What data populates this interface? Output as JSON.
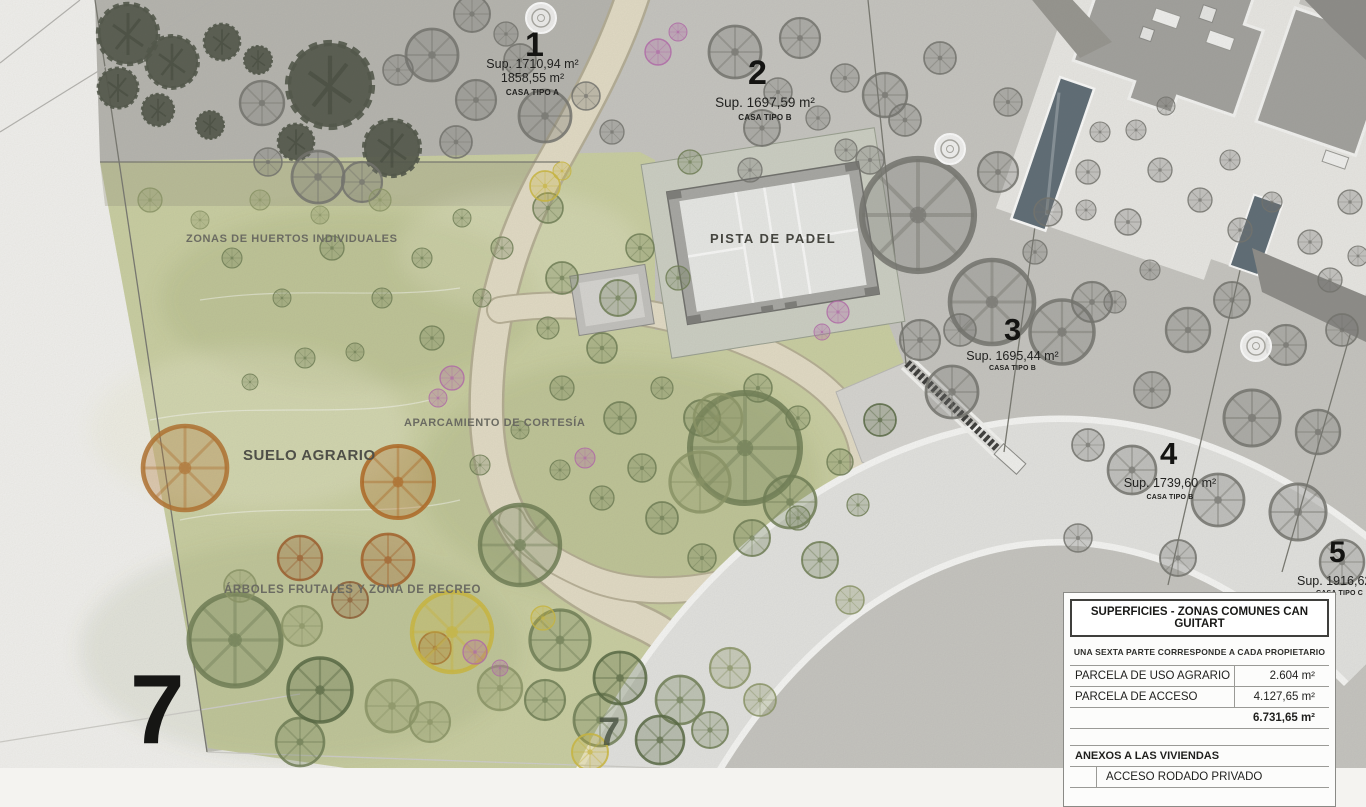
{
  "plan": {
    "plots": [
      {
        "number": "1",
        "area1": "Sup. 1710,94 m²",
        "area2": "1858,55 m²",
        "type": "CASA TIPO A"
      },
      {
        "number": "2",
        "area1": "Sup. 1697,59 m²",
        "type": "CASA TIPO B"
      },
      {
        "number": "3",
        "area1": "Sup. 1695,44 m²",
        "type": "CASA TIPO B"
      },
      {
        "number": "4",
        "area1": "Sup. 1739,60 m²",
        "type": "CASA TIPO B"
      },
      {
        "number": "5",
        "area1": "Sup. 1916,62 m²",
        "type": "CASA TIPO C"
      }
    ],
    "zones": {
      "huertos": "ZONAS DE HUERTOS INDIVIDUALES",
      "aparcamiento": "APARCAMIENTO DE CORTESÍA",
      "suelo": "SUELO AGRARIO",
      "arboles": "ÁRBOLES FRUTALES Y ZONA DE RECREO",
      "padel": "PISTA DE PADEL"
    },
    "seven_large": "7",
    "seven_small": "7"
  },
  "legend": {
    "title": "SUPERFICIES - ZONAS COMUNES CAN GUITART",
    "subtitle": "UNA SEXTA PARTE CORRESPONDE A CADA PROPIETARIO",
    "rows": [
      {
        "label": "PARCELA DE USO AGRARIO",
        "value": "2.604 m²"
      },
      {
        "label": "PARCELA DE ACCESO",
        "value": "4.127,65 m²"
      }
    ],
    "total": "6.731,65 m²",
    "section2_title": "ANEXOS A LAS VIVIENDAS",
    "section2_rows": [
      {
        "label": "ACCESO RODADO PRIVADO"
      }
    ]
  },
  "colors": {
    "green_zone": "#cbd0a2",
    "plot_gray": "#c7c6c1",
    "plot1_gray": "#b7b6b0",
    "road": "#e4e4e1",
    "path_beige": "#e4ddc6",
    "court_light": "#e9eae7",
    "pool_blue": "#5d6b74",
    "accent_orange": "#b2702c",
    "accent_magenta": "#b468aa",
    "accent_yellow": "#cdb93c"
  }
}
